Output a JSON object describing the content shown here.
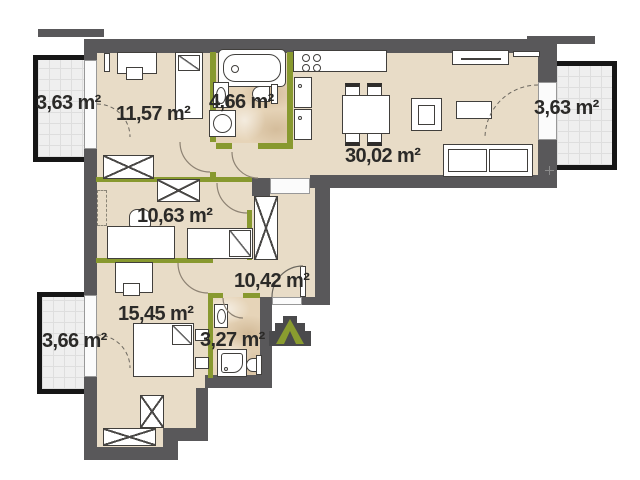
{
  "floorplan": {
    "unit": "m²",
    "rooms": [
      {
        "id": "balcony-top-left",
        "area": "3,63 m²"
      },
      {
        "id": "room-top-left",
        "area": "11,57 m²"
      },
      {
        "id": "bathroom-top",
        "area": "4,66 m²"
      },
      {
        "id": "living-room-kitchen",
        "area": "30,02 m²"
      },
      {
        "id": "balcony-right",
        "area": "3,63 m²"
      },
      {
        "id": "room-middle",
        "area": "10,63 m²"
      },
      {
        "id": "hallway",
        "area": "10,42 m²"
      },
      {
        "id": "bedroom",
        "area": "15,45 m²"
      },
      {
        "id": "balcony-bottom-left",
        "area": "3,66 m²"
      },
      {
        "id": "bathroom-bottom",
        "area": "3,27 m²"
      }
    ],
    "icons": [
      "bathtub-icon",
      "washbasin-icon",
      "washing-machine-icon",
      "toilet-icon",
      "shower-icon",
      "stove-burners-icon",
      "kitchen-cabinet-icon",
      "dining-table-icon",
      "dining-chair-icon",
      "armchair-icon",
      "tv-bench-icon",
      "sideboard-icon",
      "shelf-icon",
      "sofa-icon",
      "single-bed-icon",
      "double-bed-icon",
      "nightstand-icon",
      "desk-icon",
      "chair-icon",
      "wardrobe-icon",
      "radiator-icon",
      "door-arc",
      "entrance-door",
      "developer-logo"
    ],
    "colors": {
      "wall": "#59585a",
      "floor": "#e8dcc7",
      "partition_green": "#88992f",
      "balcony_fill": "#efefef",
      "balcony_frame": "#161616",
      "marble": "#e6d4b8",
      "logo_dark": "#4a4a4c",
      "logo_green": "#8a9c2f",
      "label_text": "#2b2a28"
    }
  }
}
